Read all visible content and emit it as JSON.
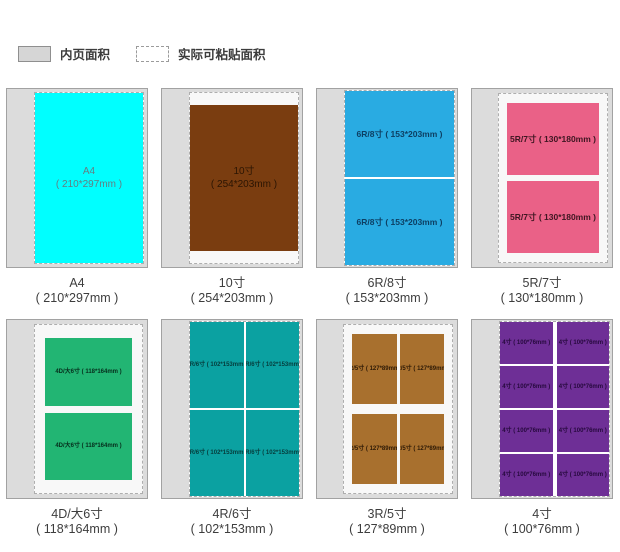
{
  "legend": {
    "inner_area_label": "内页面积",
    "paste_area_label": "实际可粘贴面积"
  },
  "colors": {
    "page_background": "#dcdcdc",
    "page_border": "#a2a2a2",
    "paste_dashed_border": "#aeaeae"
  },
  "panels": [
    {
      "name": "A4",
      "caption1": "A4",
      "caption2": "( 210*297mm )",
      "label1": "A4",
      "label2": "( 210*297mm )",
      "color": "#00ffff",
      "label_color": "#647d82",
      "photo_count": 1
    },
    {
      "name": "10寸",
      "caption1": "10寸",
      "caption2": "( 254*203mm )",
      "label1": "10寸",
      "label2": "( 254*203mm )",
      "color": "#7a3d10",
      "label_color": "#2b1503",
      "photo_count": 1
    },
    {
      "name": "6R/8寸",
      "caption1": "6R/8寸",
      "caption2": "( 153*203mm )",
      "label": "6R/8寸 ( 153*203mm )",
      "color": "#29abe2",
      "label_color": "#0d3f63",
      "photo_count": 2
    },
    {
      "name": "5R/7寸",
      "caption1": "5R/7寸",
      "caption2": "( 130*180mm )",
      "label": "5R/7寸 ( 130*180mm )",
      "color": "#ea6187",
      "label_color": "#3f1622",
      "photo_count": 2
    },
    {
      "name": "4D/大6寸",
      "caption1": "4D/大6寸",
      "caption2": "( 118*164mm )",
      "label": "4D/大6寸 ( 118*164mm )",
      "color": "#22b573",
      "label_color": "#062e1c",
      "photo_count": 2
    },
    {
      "name": "4R/6寸",
      "caption1": "4R/6寸",
      "caption2": "( 102*153mm )",
      "label": "4R/6寸 ( 102*153mm )",
      "color": "#0ba1a1",
      "label_color": "#063c3c",
      "photo_count": 4
    },
    {
      "name": "3R/5寸",
      "caption1": "3R/5寸",
      "caption2": "( 127*89mm )",
      "label": "3R/5寸 ( 127*89mm )",
      "color": "#a8702e",
      "label_color": "#2e1a06",
      "photo_count": 4
    },
    {
      "name": "4寸",
      "caption1": "4寸",
      "caption2": "( 100*76mm )",
      "label": "4寸 ( 100*76mm )",
      "color": "#6e2f96",
      "label_color": "#26093d",
      "photo_count": 8
    }
  ]
}
